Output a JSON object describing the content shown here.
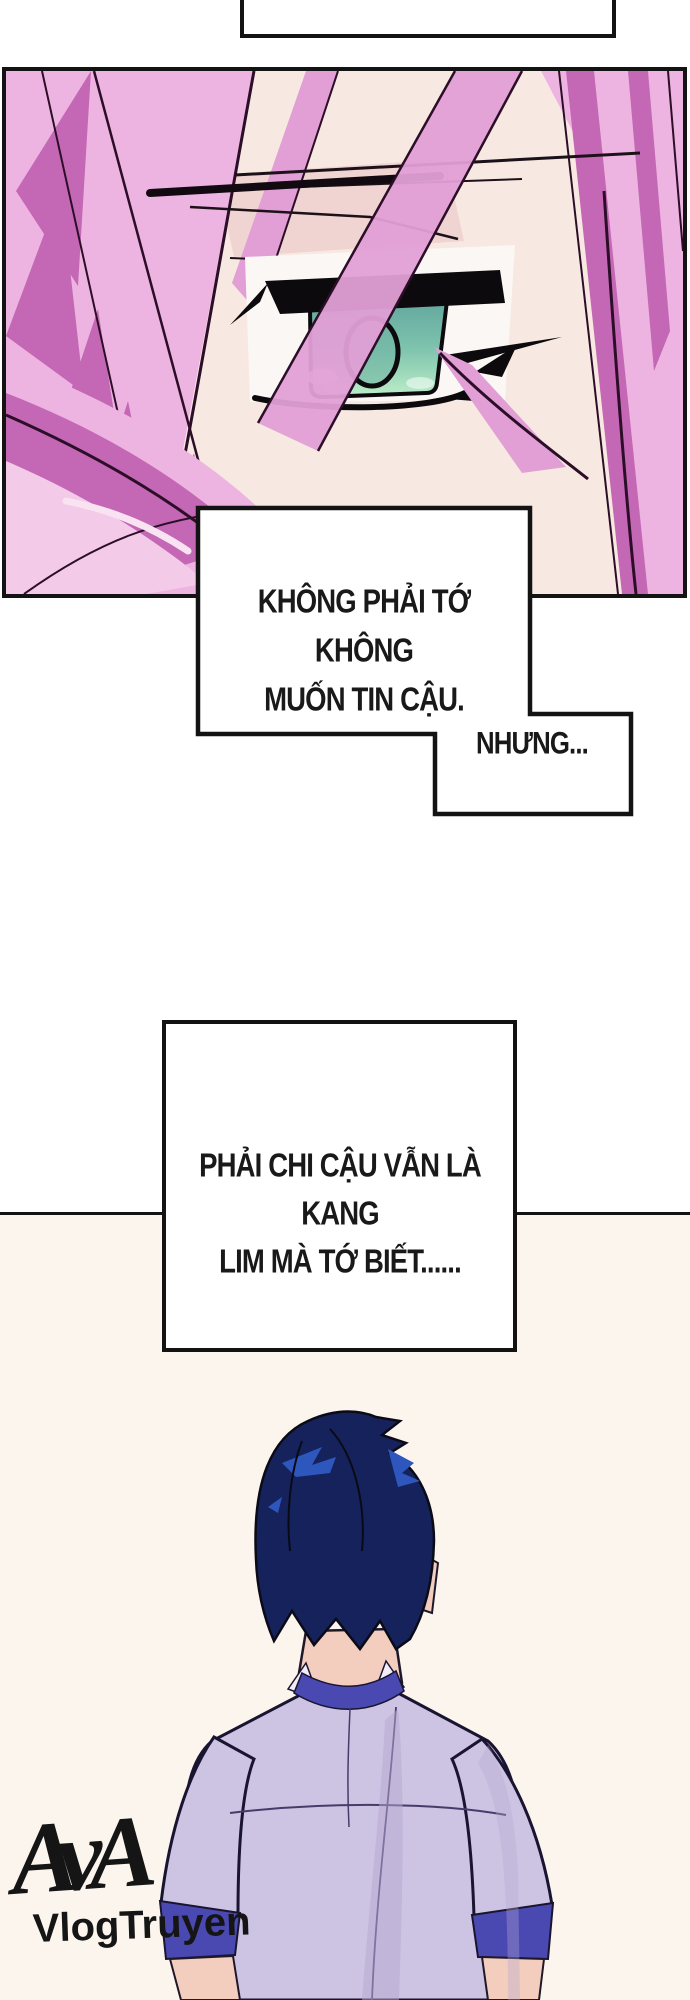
{
  "speech": {
    "bubble_top_partial": "",
    "bubble_1_line_1": "KHÔNG PHẢI TỚ KHÔNG",
    "bubble_1_line_2": "MUỐN TIN CẬU.",
    "bubble_2": "NHƯNG...",
    "bubble_3_line_1": "PHẢI CHI CẬU VẪN LÀ KANG",
    "bubble_3_line_2": "LIM MÀ TỚ BIẾT......"
  },
  "watermark": {
    "logo": "AvA",
    "site": "VlogTruyen"
  },
  "colors": {
    "ink": "#131313",
    "panel_bg": "#f7e9e1",
    "bottom_bg": "#fbf5ee",
    "hair_pink_light": "#eeb4e1",
    "hair_pink_mid": "#e29fd6",
    "hair_pink_dark": "#c468b6",
    "hair_outline": "#2c0e28",
    "skin_face_shade": "#f0d4d2",
    "sclera": "#fbf7f4",
    "iris_top": "#5fa29c",
    "iris_mid": "#7fc4ae",
    "iris_bottom": "#bdeec8",
    "eye_ink": "#0d0a0d",
    "boy_hair_navy": "#16225b",
    "boy_hair_highlight": "#2e57bd",
    "boy_outline": "#191430",
    "shirt_lavender": "#cdc3e2",
    "shirt_shadow": "#b5a9d2",
    "collar_indigo": "#4a49b2",
    "boy_skin": "#f3cdbe"
  }
}
